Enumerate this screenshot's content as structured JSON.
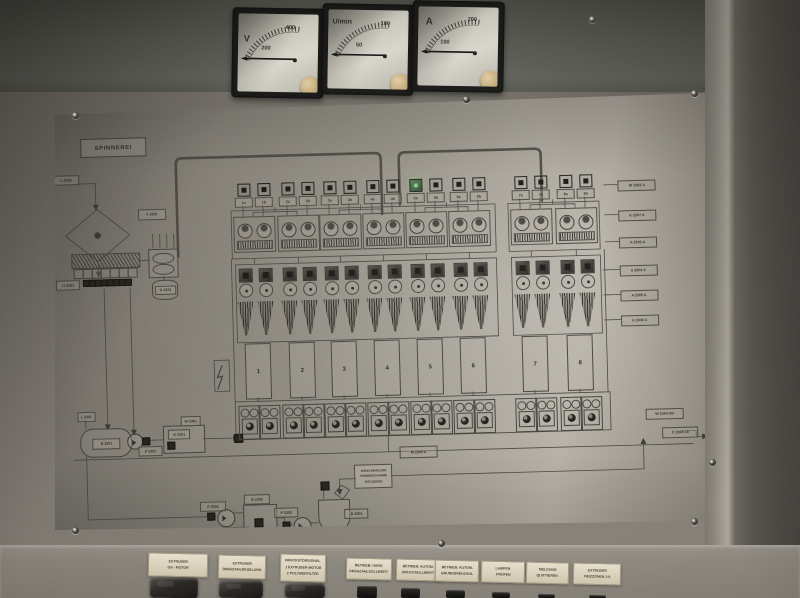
{
  "meters": [
    {
      "unit": "V",
      "tick_low": "200",
      "tick_high": "400"
    },
    {
      "unit": "U/min",
      "tick_low": "50",
      "tick_high": "100"
    },
    {
      "unit": "A",
      "tick_low": "100",
      "tick_high": "200"
    }
  ],
  "panel": {
    "title": "SPINNEREI",
    "indicators": [
      {
        "label": "1a",
        "lit": false
      },
      {
        "label": "1b",
        "lit": false
      },
      {
        "label": "2a",
        "lit": false
      },
      {
        "label": "2b",
        "lit": false
      },
      {
        "label": "3a",
        "lit": false
      },
      {
        "label": "3b",
        "lit": false
      },
      {
        "label": "4a",
        "lit": false
      },
      {
        "label": "4b",
        "lit": false
      },
      {
        "label": "5a",
        "lit": true
      },
      {
        "label": "5b",
        "lit": false
      },
      {
        "label": "6a",
        "lit": false
      },
      {
        "label": "6b",
        "lit": false
      },
      {
        "label": "7a",
        "lit": false
      },
      {
        "label": "7b",
        "lit": false
      },
      {
        "label": "8a",
        "lit": false
      },
      {
        "label": "8b",
        "lit": false
      }
    ],
    "positions": [
      "1",
      "2",
      "3",
      "4",
      "5",
      "6",
      "7",
      "8"
    ],
    "right_tags": [
      "W 2302 A",
      "K 2307 A",
      "A 2303 A",
      "A 2304 A",
      "A 2305 A",
      "A 2306 A"
    ],
    "corner_tags": [
      "W 2304 AB",
      "C 2306 18"
    ],
    "tags": {
      "inlet": "L 2302",
      "filter": "F 2301",
      "heater": "H 2301",
      "mixer": "G 2301",
      "tank_top": "L 2301",
      "tank": "B 2301",
      "pump_tank": "P 2301",
      "vessel_k": "K 2301",
      "vessel_w": "W 2301",
      "winder_drive": "M 2303 A",
      "pump_2": "P 2302",
      "pump_2_sub": "K 2302",
      "vessel_b2": "B 2302",
      "pump_3": "P 2303",
      "vessel_b3": "B 2303"
    },
    "note_lines": [
      "WENN BEHÄLTER",
      "PROBEENTNAHME",
      "ENTLEEREN"
    ]
  },
  "controls": {
    "cards": [
      {
        "lines": [
          "EXTRUDER",
          "GS - MOTOR"
        ]
      },
      {
        "lines": [
          "EXTRUDER",
          "DREHZAHLREGELUNG"
        ]
      },
      {
        "lines": [
          "DRUCKSTÖRSIGNAL",
          "1 EXTRUDER-MOTOR",
          "2 POLYMERFILTER"
        ]
      },
      {
        "lines": [
          "BETRIEB: HAND",
          "DREHZAHLSOLLWERT"
        ]
      },
      {
        "lines": [
          "BETRIEB: AUTOM.",
          "DRUCKSOLLWERT"
        ]
      },
      {
        "lines": [
          "BETRIEB: AUTOM.",
          "GRUNDDREHZAHL"
        ]
      },
      {
        "lines": [
          "LAMPEN",
          "PRÜFEN"
        ]
      },
      {
        "lines": [
          "MELDUNG",
          "QUITTIEREN"
        ]
      },
      {
        "lines": [
          "EXTRUDER",
          "HEIZZONEN 1-8"
        ]
      }
    ]
  },
  "colors": {
    "lit_green": "#5d9b5d",
    "panel_metal": "#9c978d",
    "ink": "#3e3c38"
  }
}
